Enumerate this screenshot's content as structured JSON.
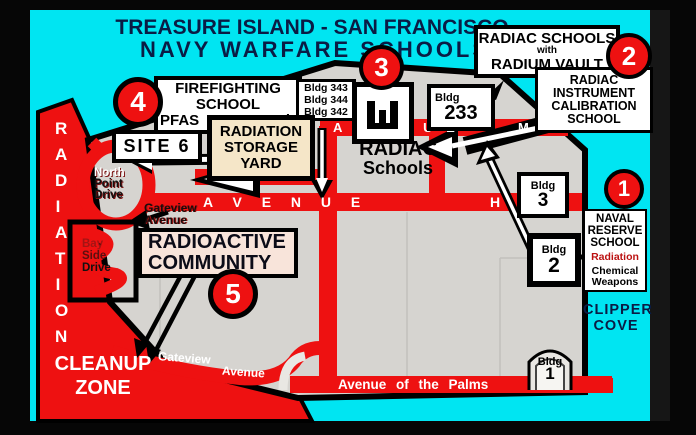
{
  "title": {
    "line1": "TREASURE ISLAND - SAN FRANCISCO",
    "line2": "NAVY WARFARE SCHOOLS"
  },
  "markers": {
    "one": "1",
    "two": "2",
    "three": "3",
    "four": "4",
    "five": "5"
  },
  "boxes": {
    "radium_vault": {
      "l1": "RADIAC SCHOOLS",
      "l2": "with",
      "l3": "RADIUM VAULT"
    },
    "instrument": {
      "l1": "RADIAC",
      "l2": "INSTRUMENT",
      "l3": "CALIBRATION",
      "l4": "SCHOOL"
    },
    "firefighting": {
      "l1": "FIREFIGHTING",
      "l2": "SCHOOL",
      "l3a": "PFAS",
      "l3b": "and"
    },
    "bldg_list": {
      "b1": "Bldg 343",
      "b2": "Bldg 344",
      "b3": "Bldg 342"
    },
    "storage": {
      "l1": "RADIATION",
      "l2": "STORAGE",
      "l3": "YARD"
    },
    "site6": "SITE 6",
    "radiac_label": {
      "l1": "RADIAC",
      "l2": "Schools"
    },
    "bldg233": {
      "small": "Bldg",
      "num": "233"
    },
    "bldg3": {
      "small": "Bldg",
      "num": "3"
    },
    "bldg2": {
      "small": "Bldg",
      "num": "2"
    },
    "bldg1": {
      "small": "Bldg",
      "num": "1"
    },
    "naval": {
      "l1": "NAVAL",
      "l2": "RESERVE",
      "l3": "SCHOOL",
      "s1": "Radiation",
      "s2": "Chemical",
      "s3": "Weapons"
    },
    "community": {
      "l1": "RADIOACTIVE",
      "l2": "COMMUNITY"
    }
  },
  "roads": {
    "avenue_m": {
      "name": "A V E N U E",
      "letter": "M"
    },
    "avenue_h": {
      "name": "A V E N U E",
      "letter": "H"
    },
    "avenue_i": {
      "name": "V E N U E",
      "letter": "I"
    },
    "palms": "Avenue of the Palms",
    "gateview": {
      "l1": "Gateview",
      "l2": "Avenue"
    }
  },
  "streets": {
    "north_point": {
      "l1": "North",
      "l2": "Point",
      "l3": "Drive"
    },
    "bay_side": {
      "l1": "Bay",
      "l2": "Side",
      "l3": "Drive"
    },
    "gateview_upper": {
      "l1": "Gateview",
      "l2": "Avenue"
    }
  },
  "zone": {
    "vertical": "RADIATION",
    "cleanup1": "CLEANUP",
    "cleanup2": "ZONE"
  },
  "water": {
    "clipper1": "CLIPPER",
    "clipper2": "COVE"
  },
  "colors": {
    "water": "#00e5f2",
    "land": "#d6d4d0",
    "road_red": "#ee1111",
    "title_navy": "#0a1c45",
    "storage_bg": "#f5e6c8",
    "community_bg": "#f8e4da",
    "marker_red": "#ee1111",
    "radiation_word_red": "#bb1111"
  }
}
